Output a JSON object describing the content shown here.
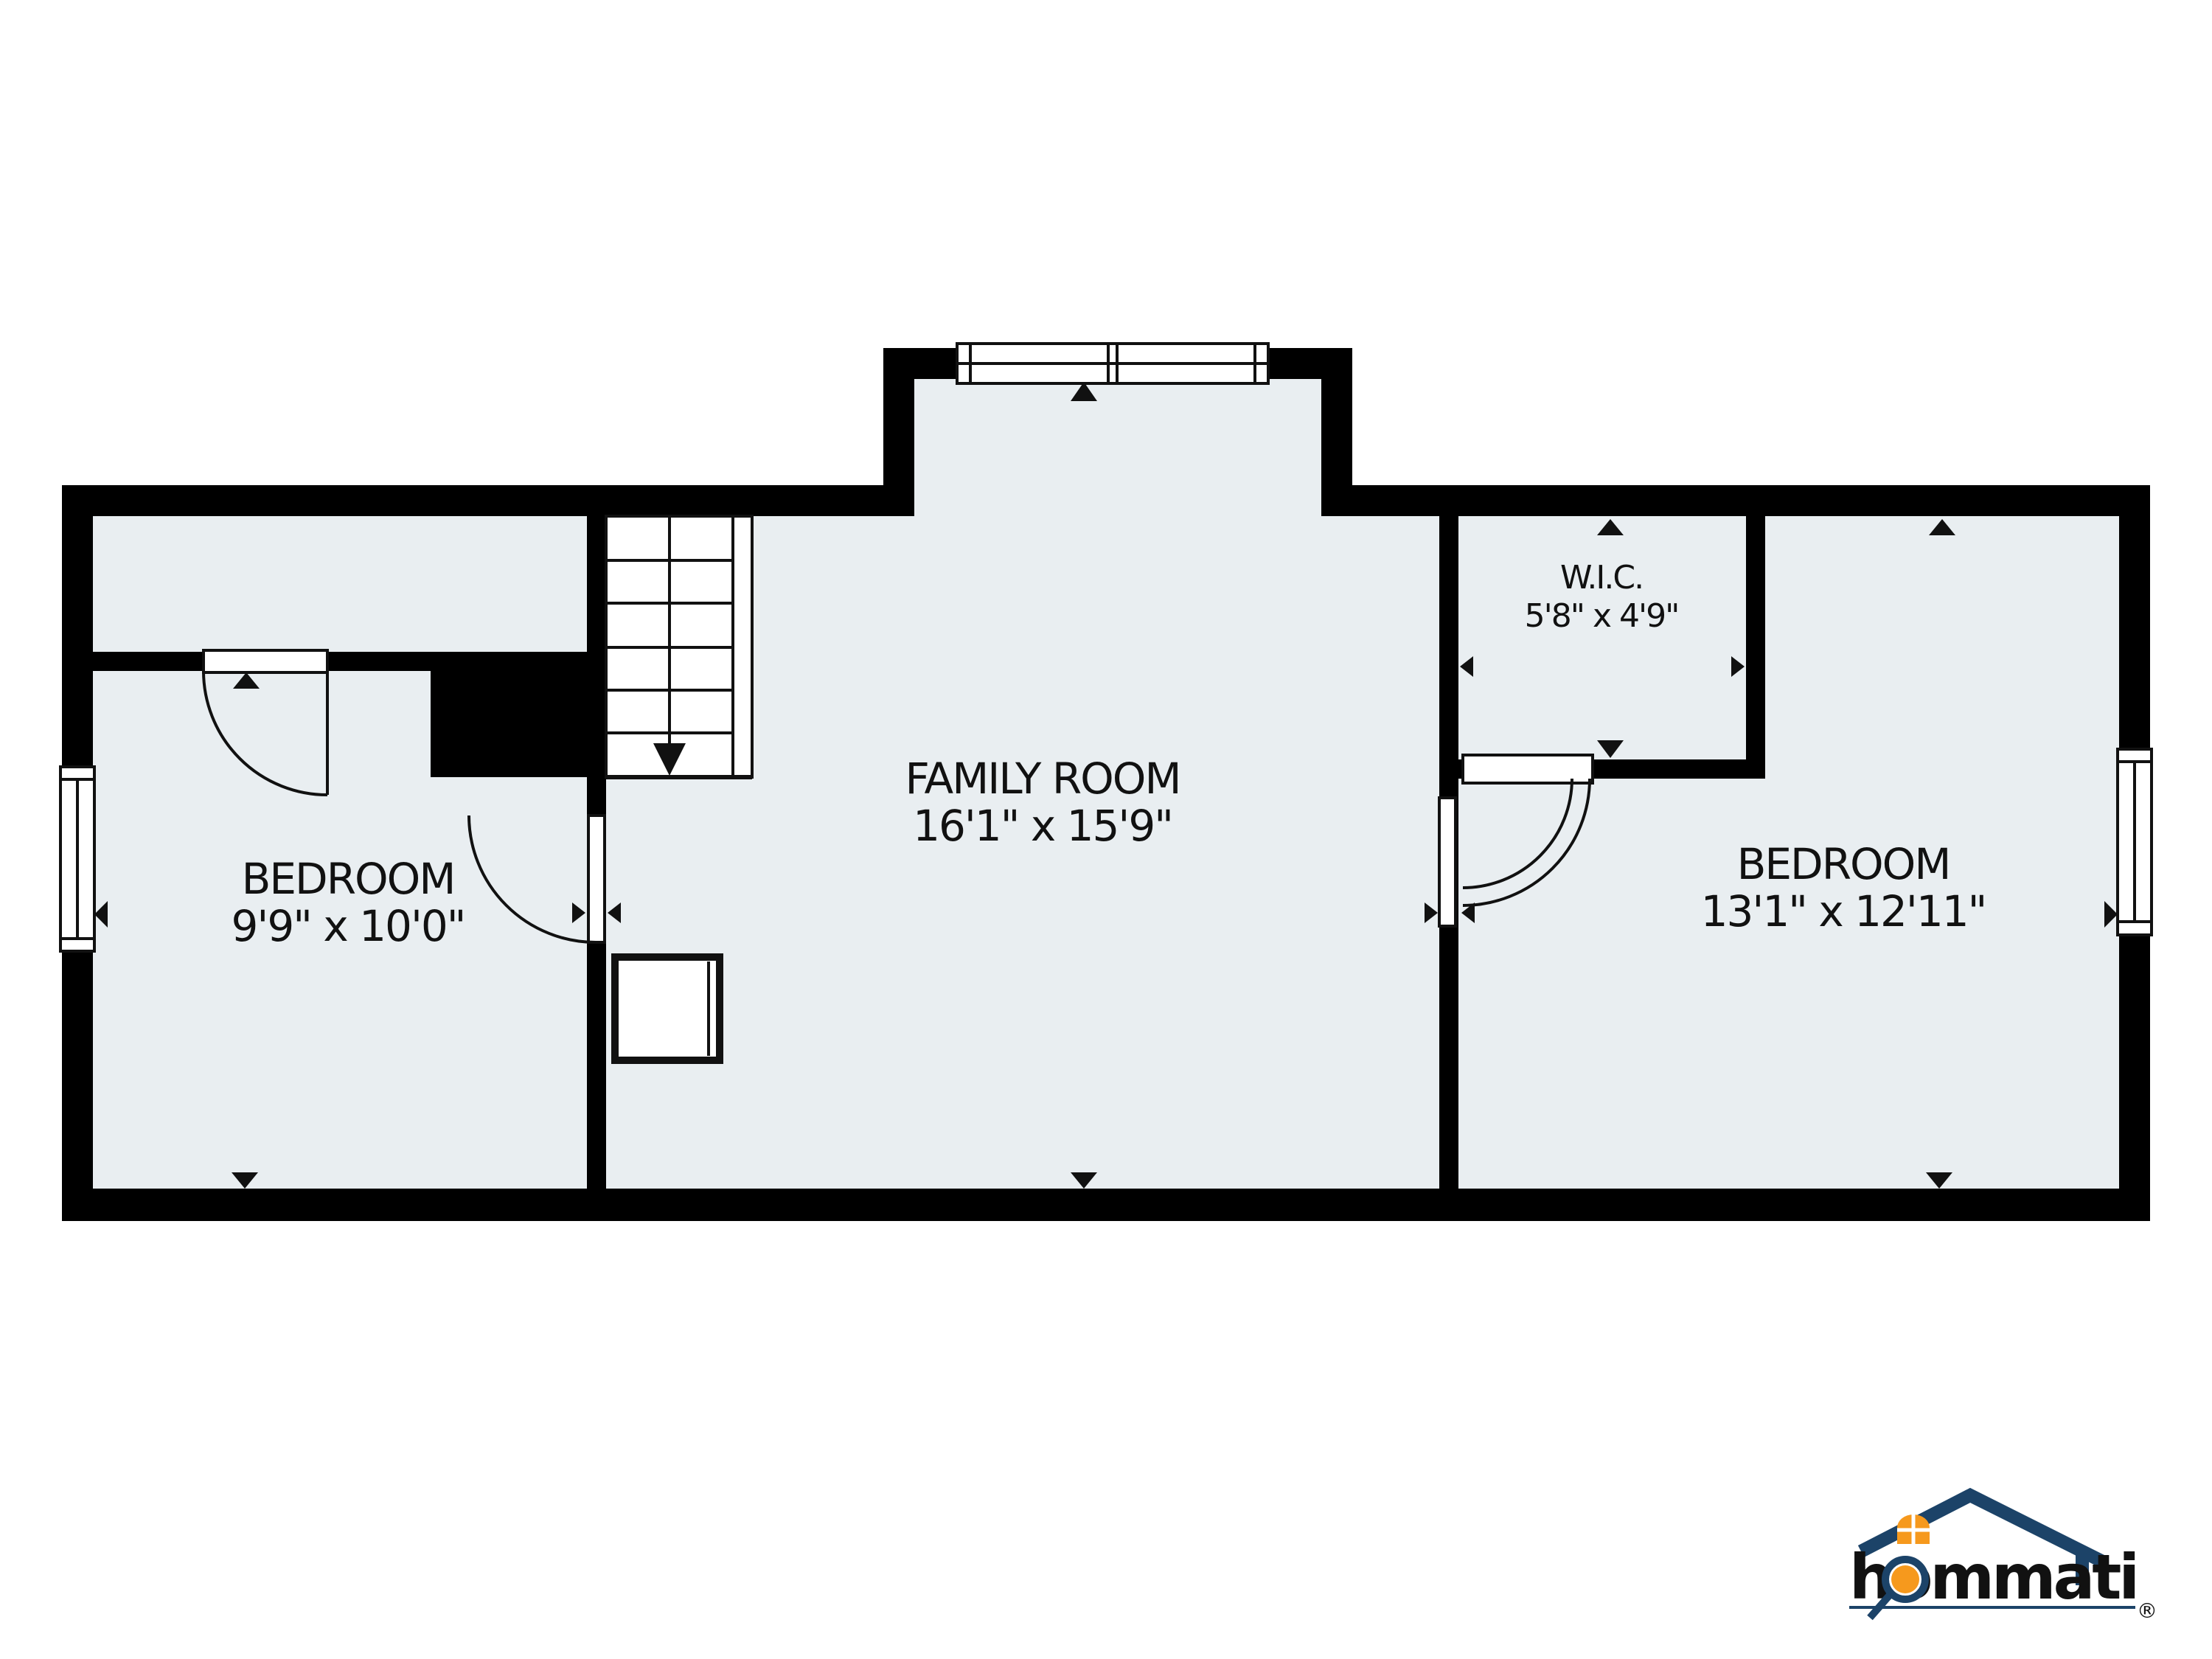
{
  "page": {
    "type": "floor-plan",
    "background": "#ffffff"
  },
  "colors": {
    "floor_fill": "#E9EEF1",
    "wall": "#000000",
    "line": "#111111",
    "logo_navy": "#1C4368",
    "logo_orange": "#F6991D",
    "registered_gray": "#8C939D"
  },
  "floor_plan": {
    "rooms": [
      {
        "name": "BEDROOM",
        "dimensions": "9'9\" x 10'0\""
      },
      {
        "name": "FAMILY ROOM",
        "dimensions": "16'1\" x 15'9\""
      },
      {
        "name": "W.I.C.",
        "dimensions": "5'8\" x 4'9\""
      },
      {
        "name": "BEDROOM",
        "dimensions": "13'1\" x 12'11\""
      }
    ],
    "icons": {
      "stairs_down_arrow": "▼",
      "door_position_marker_up": "▲",
      "door_position_marker_down": "▼",
      "window_position_marker_left": "◀",
      "window_position_marker_right": "▶"
    }
  },
  "logo": {
    "wordmark": "hommati",
    "registered": "®"
  }
}
